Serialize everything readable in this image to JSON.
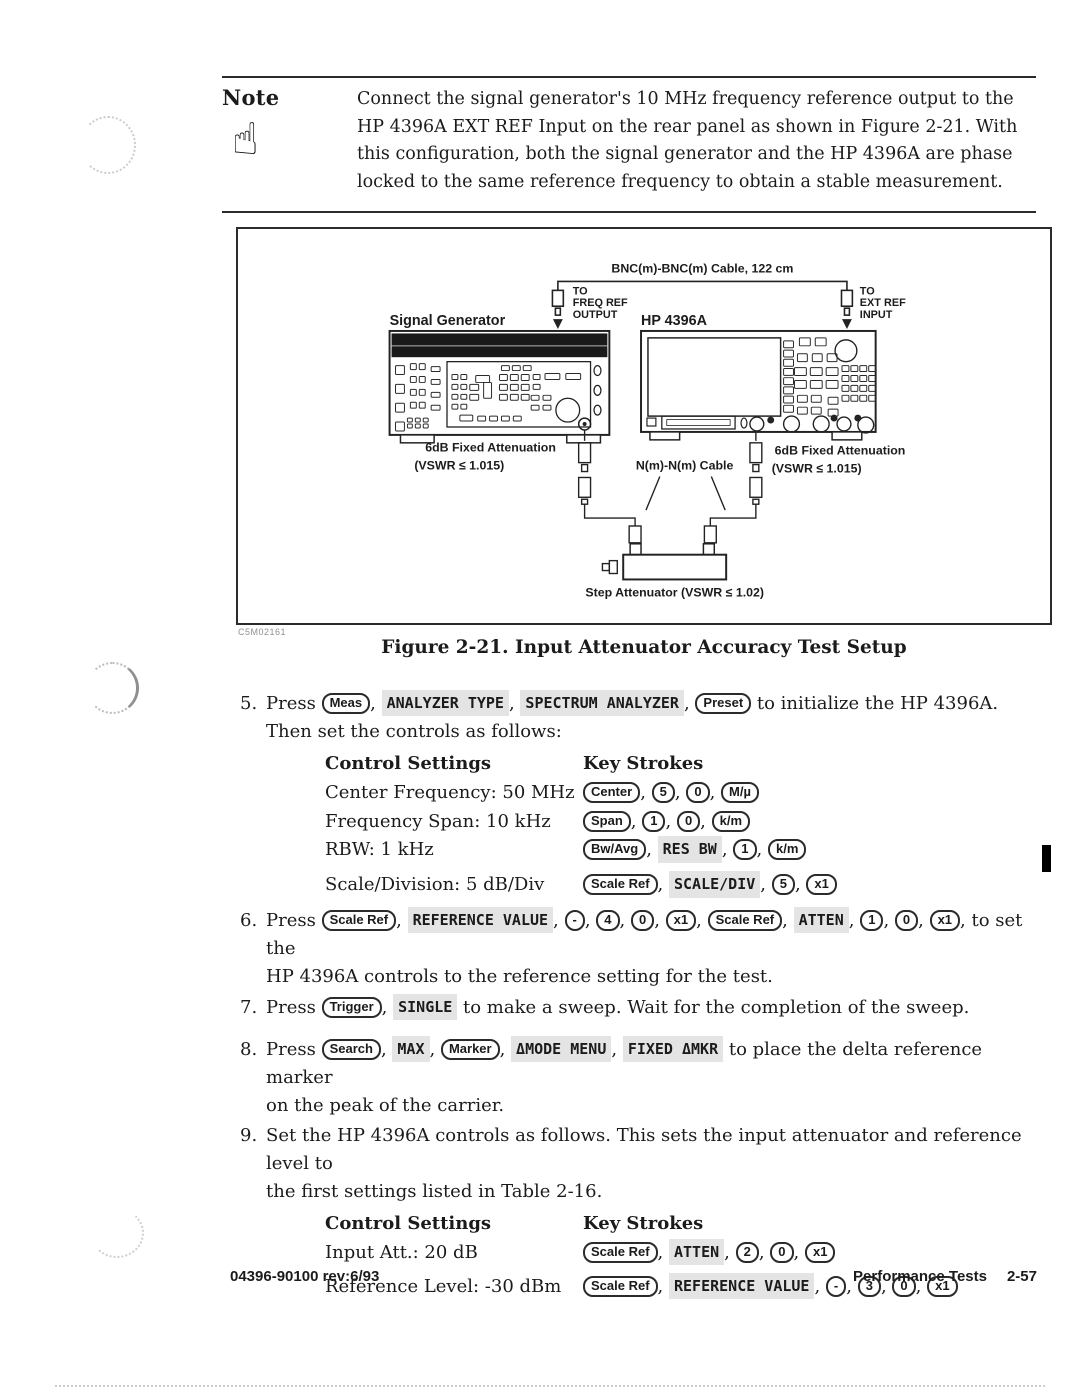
{
  "note": {
    "label": "Note",
    "icon": "pointing-hand-icon",
    "text": "Connect the signal generator's 10 MHz frequency reference output to the HP 4396A EXT REF Input on the rear panel as shown in Figure 2-21. With this configuration, both the signal generator and the HP 4396A are phase locked to the same reference frequency to obtain a stable measurement."
  },
  "figure": {
    "caption": "Figure 2-21. Input Attenuator Accuracy Test Setup",
    "artifact_code": "C5M02161",
    "labels": {
      "cable": "BNC(m)-BNC(m) Cable, 122 cm",
      "freq_ref": [
        "TO",
        "FREQ REF",
        "OUTPUT"
      ],
      "ext_ref": [
        "TO",
        "EXT REF",
        "INPUT"
      ],
      "signal_generator": "Signal Generator",
      "analyzer": "HP 4396A",
      "atten_left_1": "6dB Fixed Attenuation",
      "atten_left_2": "(VSWR ≤ 1.015)",
      "atten_right_1": "6dB Fixed Attenuation",
      "atten_right_2": "(VSWR ≤ 1.015)",
      "nn_cable": "N(m)-N(m) Cable",
      "step_atten": "Step Attenuator (VSWR ≤ 1.02)"
    }
  },
  "steps": [
    {
      "num": "5.",
      "segments": [
        {
          "t": "text",
          "v": "Press "
        },
        {
          "t": "key",
          "v": "Meas"
        },
        {
          "t": "text",
          "v": ", "
        },
        {
          "t": "soft",
          "v": "ANALYZER TYPE"
        },
        {
          "t": "text",
          "v": ", "
        },
        {
          "t": "soft",
          "v": "SPECTRUM ANALYZER"
        },
        {
          "t": "text",
          "v": ", "
        },
        {
          "t": "key",
          "v": "Preset"
        },
        {
          "t": "text",
          "v": " to initialize the HP 4396A."
        },
        {
          "t": "br"
        },
        {
          "t": "text",
          "v": "Then set the controls as follows:"
        }
      ]
    },
    {
      "num": "6.",
      "segments": [
        {
          "t": "text",
          "v": "Press "
        },
        {
          "t": "key",
          "v": "Scale Ref"
        },
        {
          "t": "text",
          "v": ", "
        },
        {
          "t": "soft",
          "v": "REFERENCE VALUE"
        },
        {
          "t": "text",
          "v": ", "
        },
        {
          "t": "key",
          "v": "-"
        },
        {
          "t": "text",
          "v": ", "
        },
        {
          "t": "key",
          "v": "4"
        },
        {
          "t": "text",
          "v": ", "
        },
        {
          "t": "key",
          "v": "0"
        },
        {
          "t": "text",
          "v": ", "
        },
        {
          "t": "key",
          "v": "x1"
        },
        {
          "t": "text",
          "v": ", "
        },
        {
          "t": "key",
          "v": "Scale Ref"
        },
        {
          "t": "text",
          "v": ", "
        },
        {
          "t": "soft",
          "v": "ATTEN"
        },
        {
          "t": "text",
          "v": ", "
        },
        {
          "t": "key",
          "v": "1"
        },
        {
          "t": "text",
          "v": ", "
        },
        {
          "t": "key",
          "v": "0"
        },
        {
          "t": "text",
          "v": ", "
        },
        {
          "t": "key",
          "v": "x1"
        },
        {
          "t": "text",
          "v": ", to set the"
        },
        {
          "t": "br"
        },
        {
          "t": "text",
          "v": "HP 4396A controls to the reference setting for the test."
        }
      ]
    },
    {
      "num": "7.",
      "segments": [
        {
          "t": "text",
          "v": "Press "
        },
        {
          "t": "key",
          "v": "Trigger"
        },
        {
          "t": "text",
          "v": ", "
        },
        {
          "t": "soft",
          "v": "SINGLE"
        },
        {
          "t": "text",
          "v": " to make a sweep. Wait for the completion of the sweep."
        }
      ]
    },
    {
      "num": "8.",
      "segments": [
        {
          "t": "text",
          "v": "Press "
        },
        {
          "t": "key",
          "v": "Search"
        },
        {
          "t": "text",
          "v": ", "
        },
        {
          "t": "soft",
          "v": "MAX"
        },
        {
          "t": "text",
          "v": ", "
        },
        {
          "t": "key",
          "v": "Marker"
        },
        {
          "t": "text",
          "v": ", "
        },
        {
          "t": "soft",
          "v": "ΔMODE MENU"
        },
        {
          "t": "text",
          "v": ", "
        },
        {
          "t": "soft",
          "v": "FIXED ΔMKR"
        },
        {
          "t": "text",
          "v": " to place the delta reference marker"
        },
        {
          "t": "br"
        },
        {
          "t": "text",
          "v": "on the peak of the carrier."
        }
      ]
    },
    {
      "num": "9.",
      "segments": [
        {
          "t": "text",
          "v": "Set the HP 4396A controls as follows. This sets the input attenuator and reference level to"
        },
        {
          "t": "br"
        },
        {
          "t": "text",
          "v": "the first settings listed in Table 2-16."
        }
      ]
    }
  ],
  "tables": [
    {
      "headers": [
        "Control Settings",
        "Key Strokes"
      ],
      "rows": [
        {
          "setting": "Center Frequency: 50 MHz",
          "keys": [
            {
              "t": "key",
              "v": "Center"
            },
            {
              "t": "key",
              "v": "5"
            },
            {
              "t": "key",
              "v": "0"
            },
            {
              "t": "key",
              "v": "M/µ"
            }
          ]
        },
        {
          "setting": "Frequency Span: 10 kHz",
          "keys": [
            {
              "t": "key",
              "v": "Span"
            },
            {
              "t": "key",
              "v": "1"
            },
            {
              "t": "key",
              "v": "0"
            },
            {
              "t": "key",
              "v": "k/m"
            }
          ]
        },
        {
          "setting": "RBW: 1 kHz",
          "keys": [
            {
              "t": "key",
              "v": "Bw/Avg"
            },
            {
              "t": "soft",
              "v": "RES BW"
            },
            {
              "t": "key",
              "v": "1"
            },
            {
              "t": "key",
              "v": "k/m"
            }
          ]
        },
        {
          "setting": "Scale/Division: 5 dB/Div",
          "gap_top": true,
          "keys": [
            {
              "t": "key",
              "v": "Scale Ref"
            },
            {
              "t": "soft",
              "v": "SCALE/DIV"
            },
            {
              "t": "key",
              "v": "5"
            },
            {
              "t": "key",
              "v": "x1"
            }
          ]
        }
      ]
    },
    {
      "headers": [
        "Control Settings",
        "Key Strokes"
      ],
      "loose": true,
      "rows": [
        {
          "setting": "Input Att.: 20 dB",
          "keys": [
            {
              "t": "key",
              "v": "Scale Ref"
            },
            {
              "t": "soft",
              "v": "ATTEN"
            },
            {
              "t": "key",
              "v": "2"
            },
            {
              "t": "key",
              "v": "0"
            },
            {
              "t": "key",
              "v": "x1"
            }
          ]
        },
        {
          "setting": "Reference Level: -30 dBm",
          "keys": [
            {
              "t": "key",
              "v": "Scale Ref"
            },
            {
              "t": "soft",
              "v": "REFERENCE VALUE"
            },
            {
              "t": "key",
              "v": "-"
            },
            {
              "t": "key",
              "v": "3"
            },
            {
              "t": "key",
              "v": "0"
            },
            {
              "t": "key",
              "v": "x1"
            }
          ]
        }
      ]
    }
  ],
  "footer": {
    "left": "04396-90100 rev:6/93",
    "right_label": "Performance Tests",
    "right_page": "2-57"
  }
}
